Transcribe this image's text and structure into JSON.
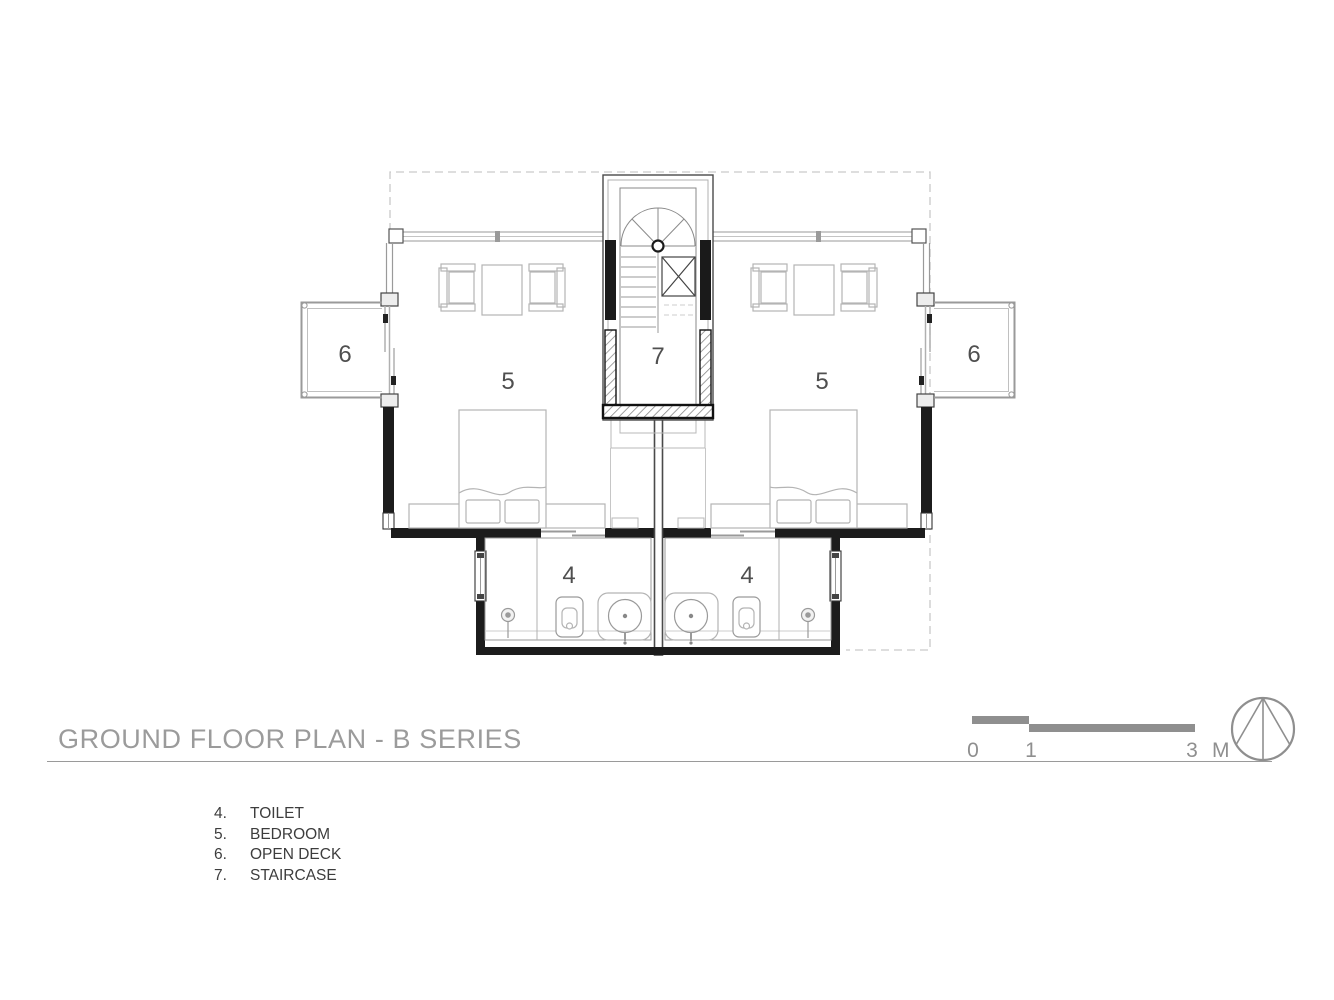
{
  "title": "GROUND FLOOR PLAN - B SERIES",
  "legend": {
    "items": [
      {
        "number": "4.",
        "label": "TOILET"
      },
      {
        "number": "5.",
        "label": "BEDROOM"
      },
      {
        "number": "6.",
        "label": "OPEN DECK"
      },
      {
        "number": "7.",
        "label": "STAIRCASE"
      }
    ]
  },
  "scale_bar": {
    "ticks": [
      "0",
      "1",
      "3"
    ],
    "unit": "M"
  },
  "plan": {
    "labels": {
      "toilet_left": "4",
      "toilet_right": "4",
      "bedroom_left": "5",
      "bedroom_right": "5",
      "deck_left": "6",
      "deck_right": "6",
      "staircase": "7"
    }
  },
  "colors": {
    "wall": "#1c1c1c",
    "drawing_gray": "#9a9a9a",
    "furniture_gray": "#b4b4b4",
    "room_label": "#4f4f4f",
    "title_gray": "#9b9b9b",
    "legend_text": "#3d3d3d",
    "scale_gray": "#8f8f8f"
  }
}
